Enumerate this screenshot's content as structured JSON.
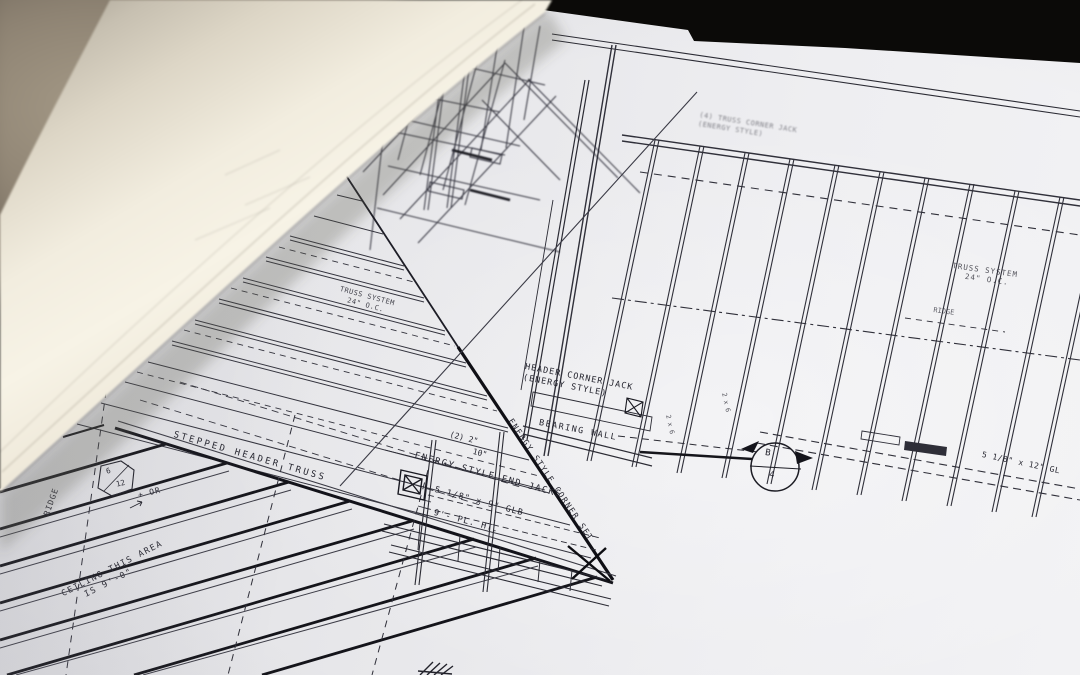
{
  "scene": {
    "subject": "Rolled architectural framing blueprints spread on a dark table"
  },
  "colors": {
    "background": "#0b0a08",
    "table_blur": "#8d8272",
    "paper_sheet": "#e9e9ec",
    "paper_roll": "#f5f1e4",
    "ink": "#2b2b34",
    "ink_heavy": "#13131a"
  },
  "plan": {
    "labels": {
      "corner_note": {
        "line1": "(4) TRUSS CORNER JACK",
        "line2": "(ENERGY STYLE)"
      },
      "truss_system_right": {
        "line1": "TRUSS SYSTEM",
        "line2": "24\" O.C."
      },
      "ridge_right": "RIDGE",
      "gl_beam": "5 1/8\" x 12\" GL",
      "truss_system_center": {
        "line1": "TRUSS SYSTEM",
        "line2": "24\" O.C."
      },
      "header_corner_jack": {
        "line1": "HEADER CORNER JACK",
        "line2": "(ENERGY STYLE)"
      },
      "bearing_wall": "BEARING WALL",
      "double_2x10": {
        "line1": "(2) 2\"",
        "line2": "10\""
      },
      "corner_set": "ENERGY STYLE CORNER SET",
      "end_jacks": "ENERGY STYLE END JACKS",
      "glb_beam": "5 1/8\" x 9\" GLB",
      "plate_height": "9'- PL. HT.",
      "stepped_header": "STEPPED HEADER TRUSS",
      "ridge_left": "RIDGE",
      "pitch": {
        "numerator": "6",
        "denominator": "12",
        "suffix": "+ OR"
      },
      "ceiling_note": {
        "line1": "CEILING THIS AREA",
        "line2": "IS 9'-0\""
      },
      "stud_a": "2 x 6",
      "stud_b": "2 x 6",
      "section_marker": {
        "top": "B",
        "bottom": "4"
      }
    }
  }
}
